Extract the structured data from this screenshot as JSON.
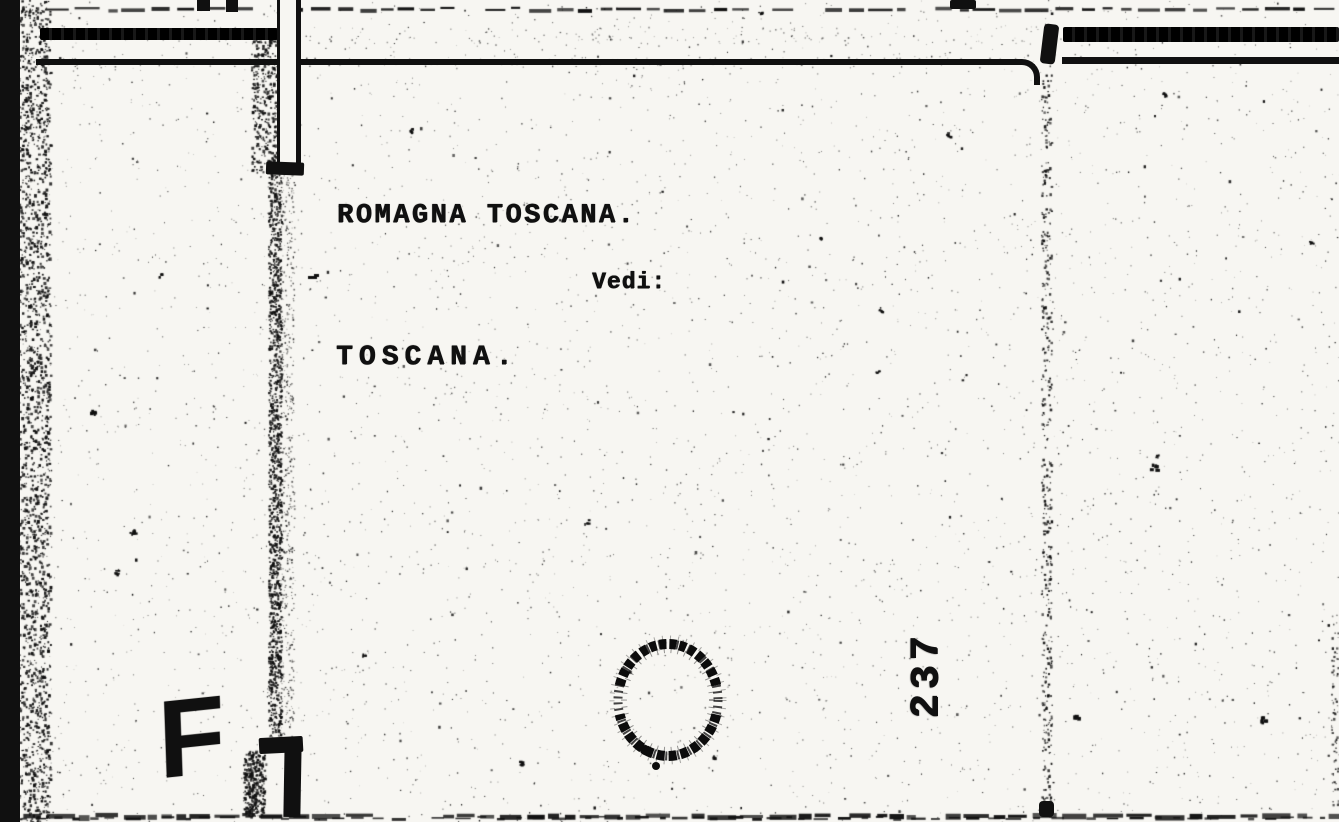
{
  "page": {
    "kind": "scanned catalog index card"
  },
  "card": {
    "heading": "ROMAGNA TOSCANA.",
    "cross_reference_label": "Vedi:",
    "cross_reference_target": "TOSCANA.",
    "sheet_number": "237",
    "handwritten_letter": "F"
  },
  "colors": {
    "paper": "#f7f6f2",
    "ink": "#101010"
  }
}
